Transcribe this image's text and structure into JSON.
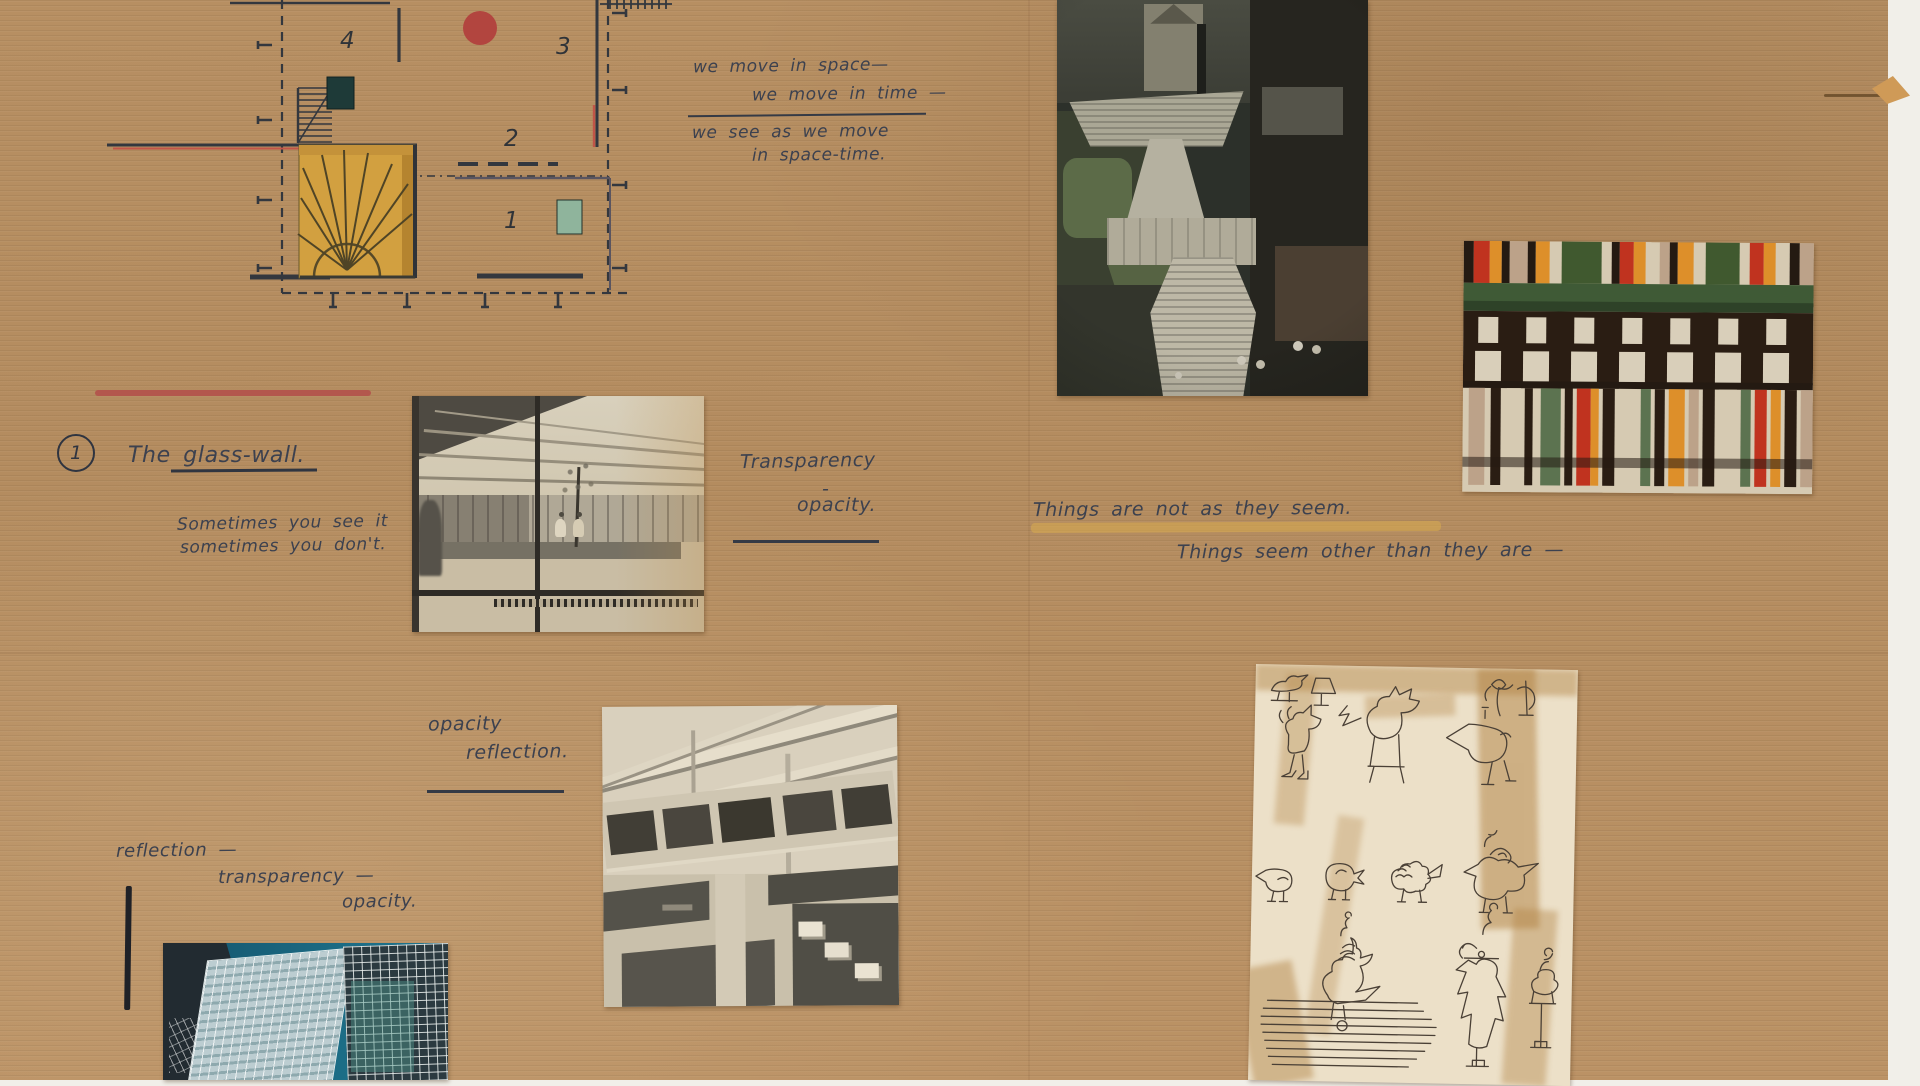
{
  "board": {
    "material": "corrugated-cardboard",
    "background_color": "#b48c5f",
    "backdrop_color": "#f1efe9",
    "ink_color": "#3c414f"
  },
  "notes": {
    "motion": {
      "line1": "we move in space—",
      "line2": "we move in time —",
      "line3": "we see as we move",
      "line4": "in space-time."
    },
    "glass_wall": {
      "number": "1",
      "title": "The glass-wall.",
      "line1": "Sometimes you see it",
      "line2": "sometimes you don't."
    },
    "transparency": {
      "line1": "Transparency",
      "line2": "-",
      "line3": "opacity."
    },
    "things": {
      "line1": "Things are not as they seem.",
      "line2": "Things seem other than they are —",
      "highlight_color": "#d9ab4f"
    },
    "opacity_reflection": {
      "line1": "opacity",
      "line2": "reflection."
    },
    "reflection_stack": {
      "line1": "reflection —",
      "line2": "transparency —",
      "line3": "opacity."
    }
  },
  "plan": {
    "labels": {
      "one": "1",
      "two": "2",
      "three": "3",
      "four": "4"
    },
    "red_dot_color": "#b2453f",
    "sun_color": "#d2a040",
    "teal_square_color": "#1e3a38",
    "green_square_color": "#8fb49c",
    "line_color": "#383b42",
    "red_line_color": "#c05548"
  },
  "images": {
    "rome": "spanish-steps-aerial-photo",
    "stripes": "striped-textile-collage",
    "glasswall": "glass-wall-interior-photo",
    "courtyard": "courtyard-aerial-photo",
    "towers": "glass-towers-photo",
    "birds": "bird-doodle-drawing"
  }
}
